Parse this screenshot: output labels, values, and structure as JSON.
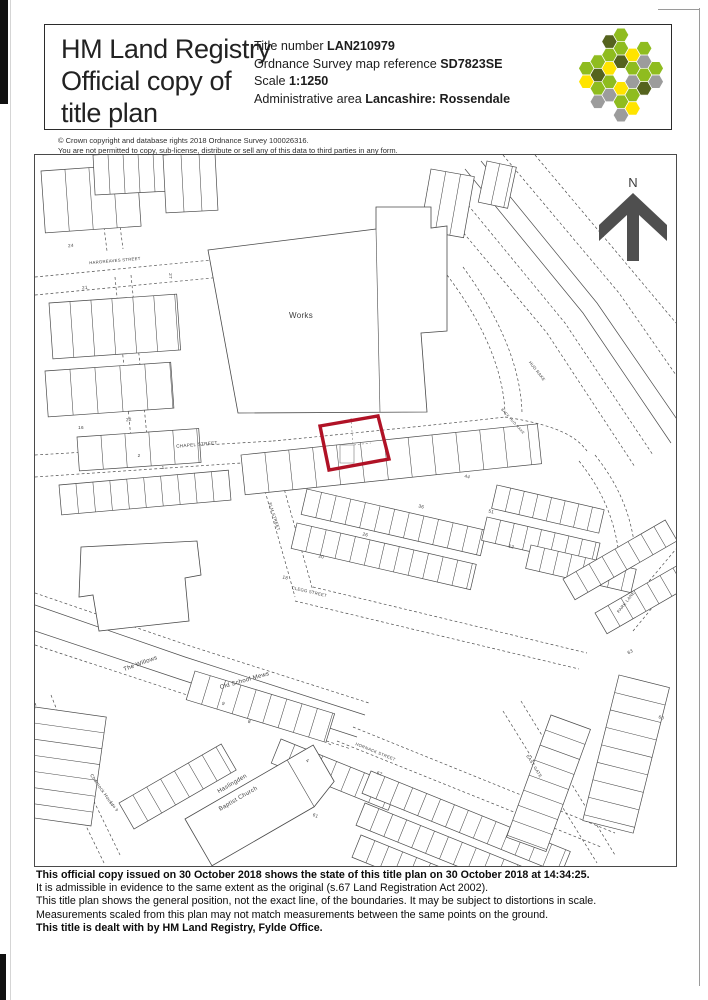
{
  "header": {
    "org": "HM Land Registry",
    "doc_line1": "Official copy of",
    "doc_line2": "title plan",
    "fields": [
      {
        "label": "Title number ",
        "value": "LAN210979"
      },
      {
        "label": "Ordnance Survey map reference ",
        "value": "SD7823SE"
      },
      {
        "label": "Scale ",
        "value": "1:1250"
      },
      {
        "label": "Administrative area ",
        "value": "Lancashire: Rossendale"
      }
    ]
  },
  "logo": {
    "palette": [
      "#8fbc1f",
      "#ffe400",
      "#9c9c9c",
      "#55631e",
      "#ffffff"
    ],
    "cells": [
      [
        0,
        0,
        4
      ],
      [
        1,
        -1,
        0
      ],
      [
        1,
        0,
        2
      ],
      [
        0,
        1,
        1
      ],
      [
        -1,
        1,
        0
      ],
      [
        -1,
        0,
        1
      ],
      [
        0,
        -1,
        3
      ],
      [
        2,
        -2,
        2
      ],
      [
        2,
        -1,
        0
      ],
      [
        2,
        0,
        3
      ],
      [
        1,
        1,
        0
      ],
      [
        0,
        2,
        0
      ],
      [
        -1,
        2,
        2
      ],
      [
        -2,
        2,
        0
      ],
      [
        -2,
        1,
        3
      ],
      [
        -2,
        0,
        0
      ],
      [
        -1,
        -1,
        0
      ],
      [
        0,
        -2,
        0
      ],
      [
        1,
        -2,
        1
      ],
      [
        3,
        -2,
        0
      ],
      [
        1,
        2,
        1
      ],
      [
        -2,
        3,
        2
      ],
      [
        -3,
        1,
        0
      ],
      [
        -1,
        -2,
        3
      ],
      [
        2,
        -3,
        0
      ],
      [
        3,
        -1,
        2
      ],
      [
        -3,
        2,
        1
      ],
      [
        0,
        -3,
        0
      ],
      [
        0,
        3,
        2
      ]
    ]
  },
  "copyright": {
    "line1": "© Crown copyright and database rights 2018 Ordnance Survey 100026316.",
    "line2": "You are not permitted to copy, sub-license, distribute or sell any of this data to third parties in any form."
  },
  "map": {
    "north_label": "N",
    "boundary_color": "#b01226",
    "labels": [
      {
        "t": "Works",
        "x": 266,
        "y": 163,
        "s": 8,
        "r": 0
      },
      {
        "t": "CHAPEL STREET",
        "x": 162,
        "y": 291,
        "s": 4.6,
        "r": -5
      },
      {
        "t": "HARGREAVES STREET",
        "x": 80,
        "y": 107,
        "s": 4.2,
        "r": -5
      },
      {
        "t": "ELM STREET",
        "x": 238,
        "y": 362,
        "s": 4.2,
        "r": 72
      },
      {
        "t": "CLEGG STREET",
        "x": 274,
        "y": 438,
        "s": 4.2,
        "r": 13
      },
      {
        "t": "The Willows",
        "x": 106,
        "y": 510,
        "s": 6,
        "r": -20
      },
      {
        "t": "Old School Mews",
        "x": 210,
        "y": 527,
        "s": 6,
        "r": -16
      },
      {
        "t": "Haslingden",
        "x": 198,
        "y": 630,
        "s": 6,
        "r": -30
      },
      {
        "t": "Baptist Church",
        "x": 204,
        "y": 645,
        "s": 6,
        "r": -30
      },
      {
        "t": "HORNACK STREET",
        "x": 340,
        "y": 598,
        "s": 4.2,
        "r": 22
      },
      {
        "t": "HUD RAKE",
        "x": 501,
        "y": 217,
        "s": 4.2,
        "r": 52
      },
      {
        "t": "BACK HUD RAKE",
        "x": 477,
        "y": 267,
        "s": 3.6,
        "r": 48
      },
      {
        "t": "PARK LANE",
        "x": 592,
        "y": 448,
        "s": 4.2,
        "r": -52
      },
      {
        "t": "EAST GATE",
        "x": 498,
        "y": 612,
        "s": 4.2,
        "r": 58
      },
      {
        "t": "Charnock House",
        "x": 66,
        "y": 636,
        "s": 4.6,
        "r": 55
      },
      {
        "t": "1 to 9",
        "x": 78,
        "y": 652,
        "s": 4,
        "r": 55
      }
    ],
    "numbers": [
      {
        "t": "24",
        "x": 36,
        "y": 92,
        "r": -4
      },
      {
        "t": "21",
        "x": 50,
        "y": 134,
        "r": -4
      },
      {
        "t": "27",
        "x": 134,
        "y": 121,
        "r": 90
      },
      {
        "t": "22",
        "x": 94,
        "y": 266,
        "r": -4
      },
      {
        "t": "16",
        "x": 46,
        "y": 274,
        "r": 0
      },
      {
        "t": "2",
        "x": 104,
        "y": 302,
        "r": 0
      },
      {
        "t": "1",
        "x": 128,
        "y": 314,
        "r": 0
      },
      {
        "t": "44",
        "x": 432,
        "y": 323,
        "r": 12
      },
      {
        "t": "36",
        "x": 386,
        "y": 353,
        "r": 12
      },
      {
        "t": "26",
        "x": 330,
        "y": 381,
        "r": 12
      },
      {
        "t": "20",
        "x": 286,
        "y": 403,
        "r": 12
      },
      {
        "t": "18",
        "x": 250,
        "y": 424,
        "r": 12
      },
      {
        "t": "51",
        "x": 456,
        "y": 358,
        "r": 12
      },
      {
        "t": "12",
        "x": 476,
        "y": 393,
        "r": 12
      },
      {
        "t": "9",
        "x": 188,
        "y": 550,
        "r": 17
      },
      {
        "t": "8",
        "x": 214,
        "y": 568,
        "r": 17
      },
      {
        "t": "4",
        "x": 272,
        "y": 607,
        "r": 22
      },
      {
        "t": "61",
        "x": 280,
        "y": 662,
        "r": 22
      },
      {
        "t": "67",
        "x": 344,
        "y": 620,
        "r": 22
      },
      {
        "t": "60",
        "x": 626,
        "y": 564,
        "r": 14
      },
      {
        "t": "63",
        "x": 596,
        "y": 498,
        "r": -30
      }
    ]
  },
  "footer": {
    "lines": [
      {
        "text": "This official copy issued on 30 October 2018 shows the state of this title plan on 30 October 2018 at 14:34:25."
      },
      {
        "text": "It is admissible in evidence to the same extent as the original (s.67 Land Registration Act 2002)."
      },
      {
        "text": "This title plan shows the general position, not the exact line, of the boundaries. It may be subject to distortions in scale."
      },
      {
        "text": "Measurements scaled from this plan may not match measurements between the same points on the ground."
      },
      {
        "text": "This title is dealt with by HM Land Registry, Fylde Office."
      }
    ]
  }
}
